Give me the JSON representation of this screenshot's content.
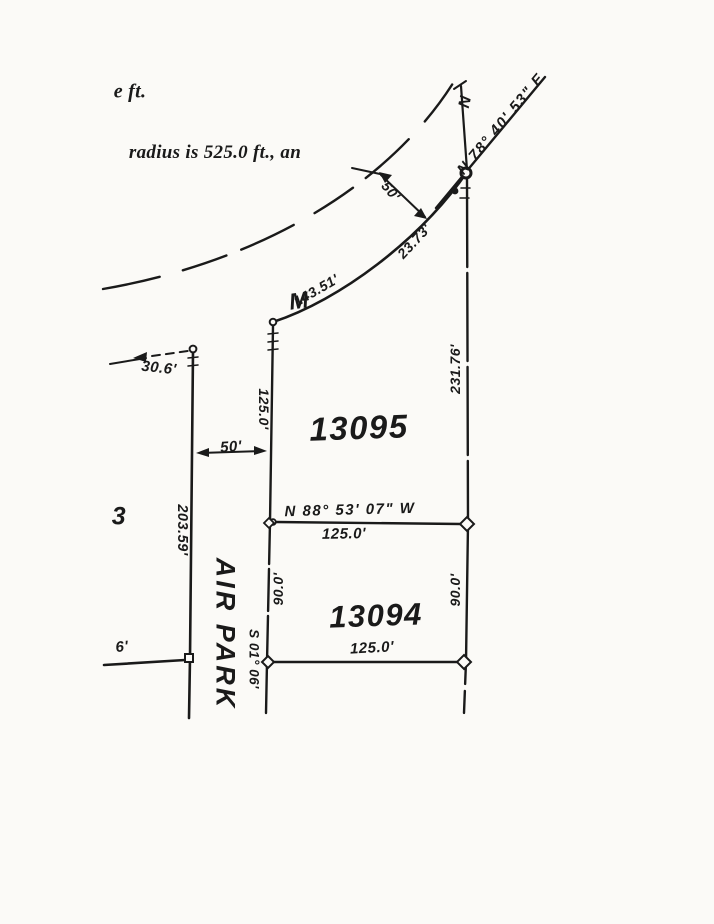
{
  "notes": {
    "top_partial": "e ft.",
    "radius_line": "radius is 525.0 ft., an"
  },
  "street": {
    "name": "AIR PARK"
  },
  "lots": {
    "upper": "13095",
    "lower": "13094",
    "left_partial": "3"
  },
  "points": {
    "m_label": "M"
  },
  "bearings": {
    "curve_tangent_ne": "N 78° 40' 53\" E",
    "north_partial": "N",
    "lot_division": "N 88° 53' 07\" W",
    "street_line": "S 01° 06'"
  },
  "dimensions": {
    "half_width_curve": "50'",
    "arc_a": "23.73'",
    "arc_b": "143.51'",
    "setback_left": "30.6'",
    "lot13095_west": "125.0'",
    "lot13095_east": "231.76'",
    "street_width": "50'",
    "left_boundary": "203.59'",
    "division_length": "125.0'",
    "lot13094_west": "90.0'",
    "lot13094_east": "90.0'",
    "lot13094_south": "125.0'",
    "stub": "6'"
  },
  "colors": {
    "ink": "#1a1a1a",
    "paper": "#fbfaf7"
  }
}
